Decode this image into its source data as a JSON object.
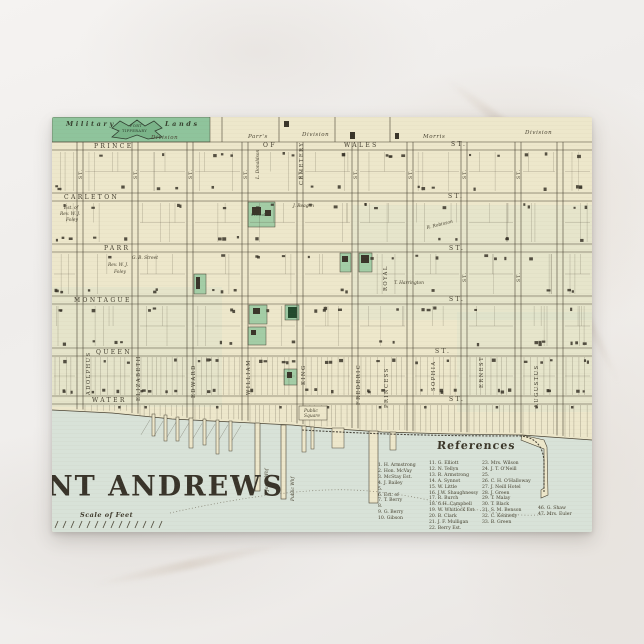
{
  "postcard": {
    "map_title": "NT ANDREWS",
    "scale_label": "Scale of Feet",
    "top_band": {
      "military": "Military",
      "lands": "Lands",
      "fort_line1": "FORT",
      "fort_line2": "TIPPERARY",
      "division_a": "Division",
      "parrs": "Parr's",
      "division_b": "Division",
      "morris": "Morris",
      "division_c": "Division"
    },
    "streets": {
      "st_label": "ST.",
      "prince": "PRINCE",
      "of": "OF",
      "wales": "WALES",
      "carleton": "CARLETON",
      "parr": "PARR",
      "montague": "MONTAGUE",
      "queen": "QUEEN",
      "water": "WATER",
      "royal": "ROYAL",
      "cemetery": "CEMETERY",
      "vertical": [
        "ADOLPHUS",
        "ELIZABETH",
        "EDWARD",
        "WILLIAM",
        "KING",
        "FREDERIC",
        "PRINCESS",
        "SOPHIA",
        "ERNEST",
        "AUGUSTUS"
      ]
    },
    "landmarks": {
      "school": "School",
      "est_of": "Est. of",
      "foley_line1": "Rev. W. J.",
      "foley_line2": "Foley",
      "gb_street": "G. B. Street",
      "reagan": "J. Reagan",
      "robinson": "R. Robinson",
      "harrington": "T. Harrington",
      "donaldson": "L. Donaldson",
      "public_square_line1": "Public",
      "public_square_line2": "Square",
      "jones_whf": "Jones Whf",
      "public_whf": "Public Whf"
    },
    "references": {
      "heading": "References",
      "col1": [
        "1. H. Armstrong",
        "2. Hon. McVay",
        "3. McStay Est.",
        "4. J. Bailey",
        "5.",
        "6. Est. of",
        "7. T. Berry",
        "8.",
        "9. G. Berry",
        "10. Gibson"
      ],
      "col2": [
        "11. G. Elliott",
        "12. N. Tellyn",
        "13. R. Armstrong",
        "14. A. Synnot",
        "15. W. Little",
        "16. J.W. Shaughnessy",
        "17. R. Burch",
        "18. G.H. Campbell",
        "19. W. Whitlock Est.",
        "20. B. Clark",
        "21. J. F. Mulligan",
        "22. Berry Est."
      ],
      "col3": [
        "23. Mrs. Wilson",
        "24. J. T. O'Neill",
        "25.",
        "26. C. H. O'Halloway",
        "27. J. Neill Hotel",
        "28. J. Green",
        "29. T. Malay",
        "30. T. Black",
        "31. S. M. Benson",
        "32. C. Kennedy",
        "33. B. Green"
      ],
      "col4": [
        "46. G. Shaw",
        "47. Mrs. Euler"
      ]
    }
  },
  "colors": {
    "paper": "#ede7cb",
    "water": "#d8e2d8",
    "military_green": "#8fc49c",
    "block_green": "#a3cda6",
    "church_green": "#234a2d",
    "ink": "#4a4435",
    "building": "#3a352a"
  }
}
